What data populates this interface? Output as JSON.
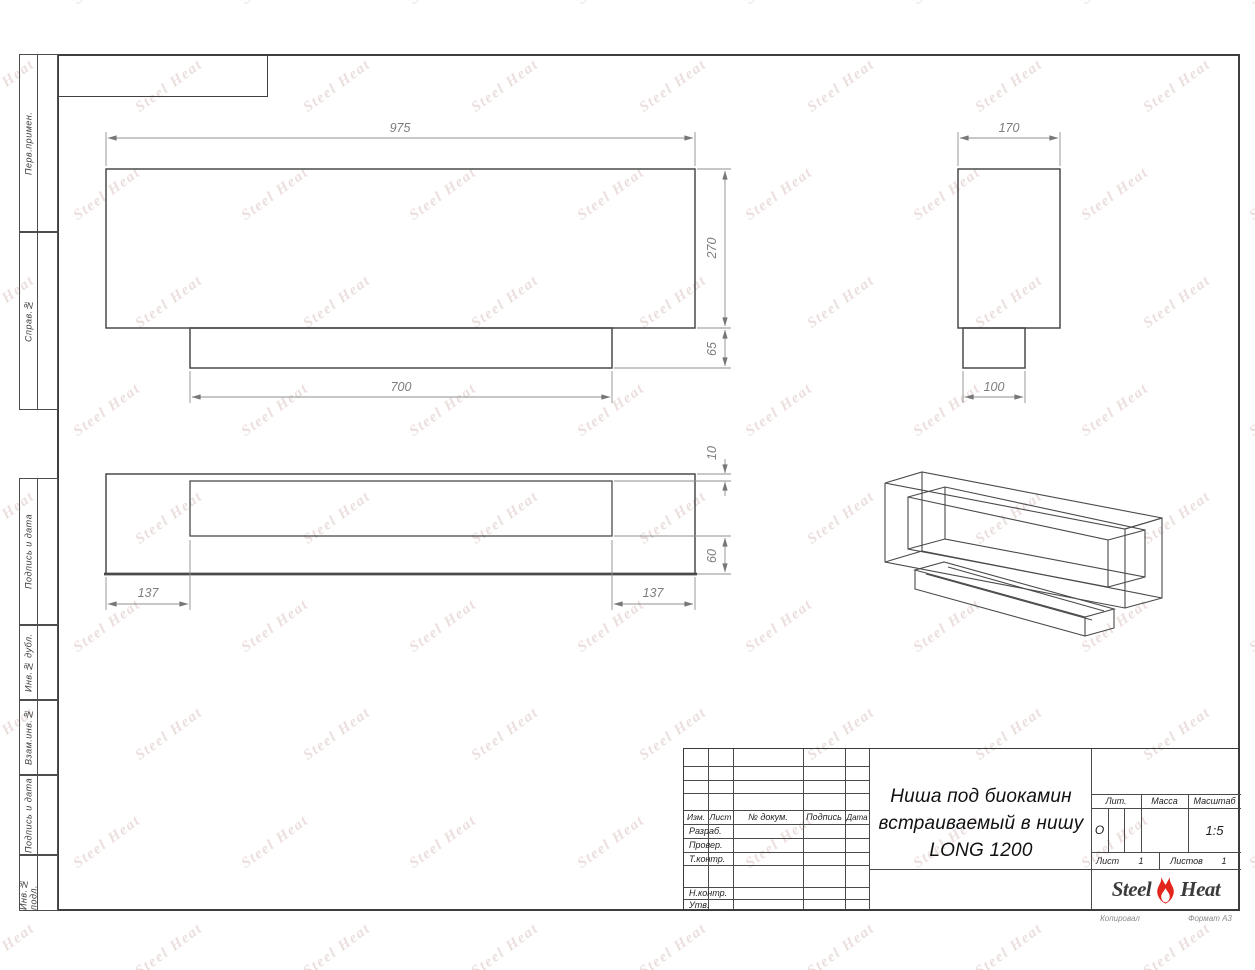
{
  "watermark": {
    "text": "Steel Heat"
  },
  "margin": {
    "labels": [
      "Перв.примен.",
      "Справ.№",
      "Подпись и дата",
      "Инв.№ дубл.",
      "Взам.инв.№",
      "Подпись и дата",
      "Инв.№ подл."
    ]
  },
  "dims": {
    "front_width": "975",
    "front_height": "270",
    "base_height": "65",
    "base_width": "700",
    "side_width": "170",
    "side_base_width": "100",
    "plan_top_offset": "10",
    "plan_bottom_offset": "60",
    "plan_left_margin": "137",
    "plan_right_margin": "137"
  },
  "title_block": {
    "change_cols": [
      "Изм.",
      "Лист",
      "№ докум.",
      "Подпись",
      "Дата"
    ],
    "sign_labels": [
      "Разраб.",
      "Провер.",
      "Т.контр.",
      "Н.контр.",
      "Утв."
    ],
    "title_lines": [
      "Ниша под биокамин",
      "встраиваемый в нишу",
      "LONG 1200"
    ],
    "lit_label": "Лит.",
    "lit_value": "О",
    "mass_label": "Масса",
    "scale_label": "Масштаб",
    "scale_value": "1:5",
    "sheet_label": "Лист",
    "sheet_value": "1",
    "sheets_label": "Листов",
    "sheets_value": "1",
    "logo_left": "Steel",
    "logo_right": "Heat"
  },
  "footer": {
    "copied": "Копировал",
    "format": "Формат А3"
  },
  "colors": {
    "flame_red": "#e2261c",
    "drawing_line": "#4a4a4a",
    "dim_line": "#8f8f8f"
  }
}
